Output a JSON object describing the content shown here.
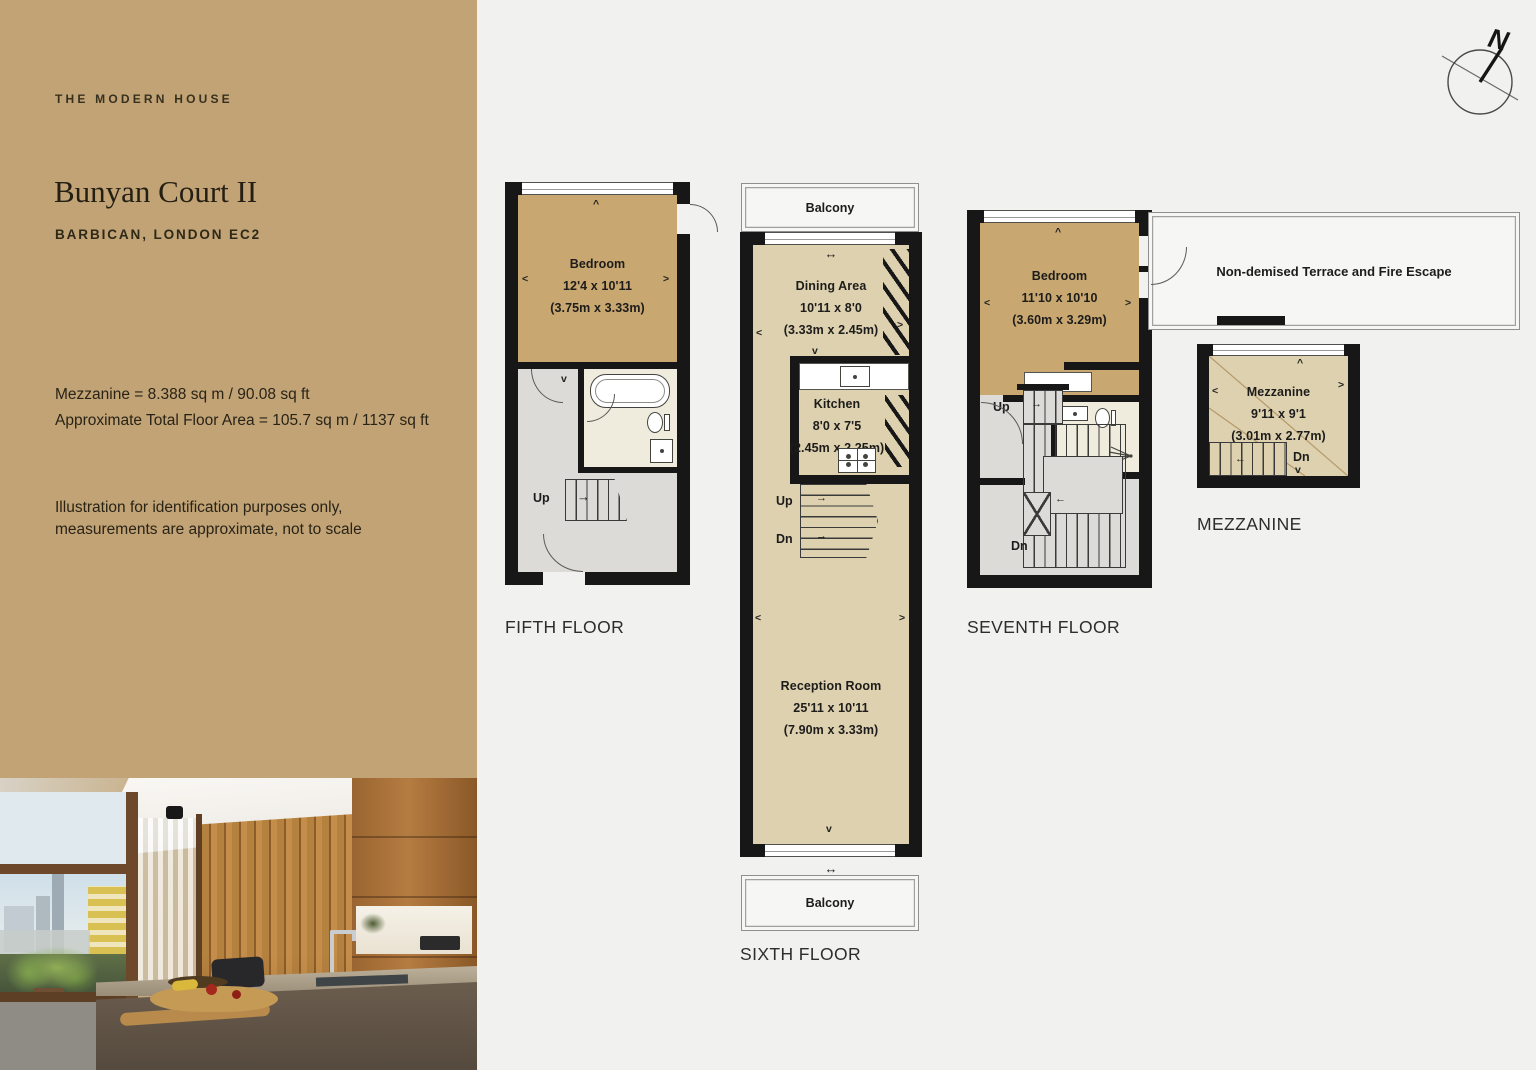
{
  "page": {
    "bg": "#f1f1ef"
  },
  "sidebar": {
    "accent": "#c1a376",
    "brand": "THE MODERN HOUSE",
    "title": "Bunyan Court II",
    "subtitle": "BARBICAN, LONDON EC2",
    "area_line1": "Mezzanine = 8.388 sq m / 90.08 sq ft",
    "area_line2": "Approximate Total Floor Area = 105.7 sq m / 1137 sq ft",
    "disclaimer_line1": "Illustration for identification purposes only,",
    "disclaimer_line2": "measurements are approximate, not to scale"
  },
  "compass": {
    "n": "N"
  },
  "symbols": {
    "left": "<",
    "right": ">",
    "up": "^",
    "down": "v",
    "slide": "↔",
    "stair_right": "→",
    "stair_left": "←"
  },
  "plans": {
    "fifth": {
      "caption": "FIFTH FLOOR",
      "up": "Up",
      "bedroom": {
        "name": "Bedroom",
        "imperial": "12'4 x 10'11",
        "metric": "(3.75m x 3.33m)"
      }
    },
    "sixth": {
      "caption": "SIXTH FLOOR",
      "balcony_top": "Balcony",
      "balcony_bottom": "Balcony",
      "up": "Up",
      "dn": "Dn",
      "dining": {
        "name": "Dining Area",
        "imperial": "10'11 x 8'0",
        "metric": "(3.33m x 2.45m)"
      },
      "kitchen": {
        "name": "Kitchen",
        "imperial": "8'0 x 7'5",
        "metric": "(2.45m x 2.25m)"
      },
      "reception": {
        "name": "Reception Room",
        "imperial": "25'11 x 10'11",
        "metric": "(7.90m x 3.33m)"
      }
    },
    "seventh": {
      "caption": "SEVENTH FLOOR",
      "up": "Up",
      "dn": "Dn",
      "bedroom": {
        "name": "Bedroom",
        "imperial": "11'10 x 10'10",
        "metric": "(3.60m x 3.29m)"
      },
      "terrace": "Non-demised Terrace and Fire Escape"
    },
    "mezzanine": {
      "caption": "MEZZANINE",
      "dn": "Dn",
      "room": {
        "name": "Mezzanine",
        "imperial": "9'11 x 9'1",
        "metric": "(3.01m x 2.77m)"
      }
    }
  }
}
